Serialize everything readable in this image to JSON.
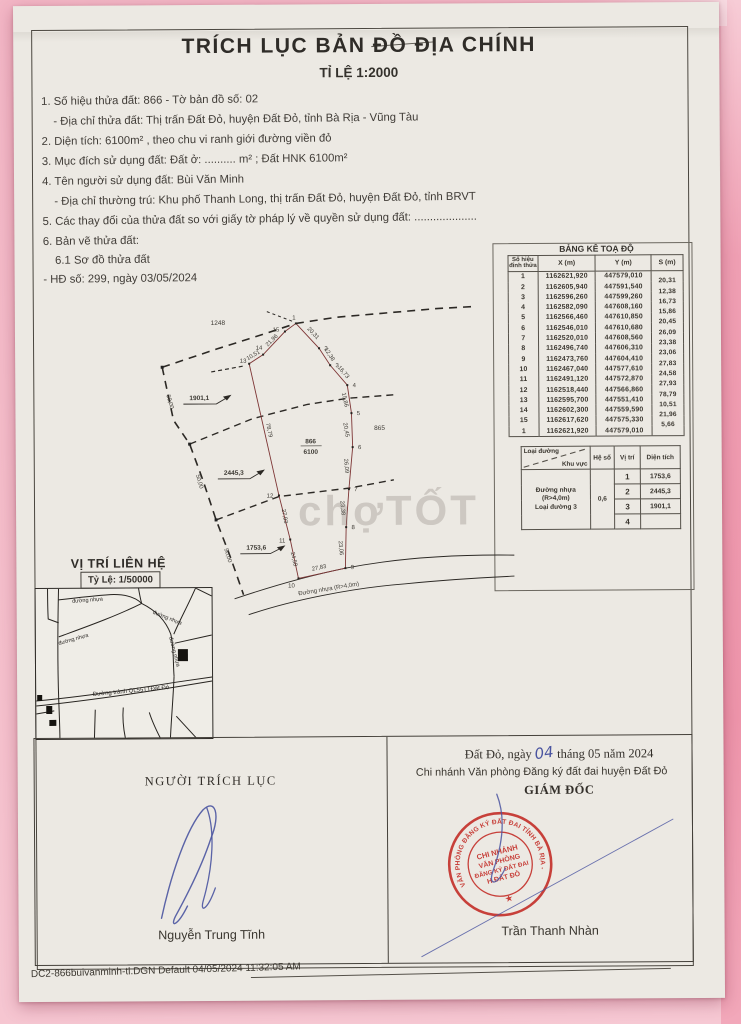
{
  "document": {
    "title": "TRÍCH LỤC BẢN ĐỒ ĐỊA CHÍNH",
    "subtitle": "TỈ LỆ 1:2000",
    "info": {
      "l1": "1. Số hiệu thửa đất:    866      - Tờ bản đồ số:   02",
      "l2": "- Địa chỉ thửa đất: Thị trấn Đất Đỏ, huyện Đất Đỏ, tỉnh Bà Rịa - Vũng Tàu",
      "l3": "2. Diện tích: 6100m² , theo chu vi ranh giới đường viền đỏ",
      "l4": "3. Mục đích sử dụng đất: Đất ở: .......... m² ; Đất HNK  6100m²",
      "l5": "4. Tên người sử dụng đất:  Bùi Văn Minh",
      "l6": "- Địa chỉ thường trú: Khu phố Thanh Long, thị trấn Đất Đỏ, huyện Đất Đỏ, tỉnh BRVT",
      "l7": "5. Các thay đổi của thửa đất so với giấy tờ pháp lý về quyền sử dụng đất: ....................",
      "l8": "6. Bản vẽ thửa đất:",
      "l9": "6.1 Sơ đồ thửa đất",
      "l10": "- HĐ số:  299, ngày 03/05/2024"
    }
  },
  "coord_table": {
    "title": "BẢNG KÊ TOẠ ĐỘ",
    "headers": [
      "Số hiệu đỉnh thửa",
      "X (m)",
      "Y (m)",
      "S (m)"
    ],
    "rows": [
      [
        "1",
        "1162621,920",
        "447579,010",
        "20,31"
      ],
      [
        "2",
        "1162605,940",
        "447591,540",
        "12,38"
      ],
      [
        "3",
        "1162596,260",
        "447599,260",
        "16,73"
      ],
      [
        "4",
        "1162582,090",
        "447608,160",
        "15,86"
      ],
      [
        "5",
        "1162566,460",
        "447610,850",
        "20,45"
      ],
      [
        "6",
        "1162546,010",
        "447610,680",
        "26,09"
      ],
      [
        "7",
        "1162520,010",
        "447608,560",
        "23,38"
      ],
      [
        "8",
        "1162496,740",
        "447606,310",
        "23,06"
      ],
      [
        "9",
        "1162473,760",
        "447604,410",
        "27,83"
      ],
      [
        "10",
        "1162467,040",
        "447577,610",
        "24,58"
      ],
      [
        "11",
        "1162491,120",
        "447572,870",
        "27,93"
      ],
      [
        "12",
        "1162518,440",
        "447566,860",
        "78,79"
      ],
      [
        "13",
        "1162595,700",
        "447551,410",
        "10,51"
      ],
      [
        "14",
        "1162602,300",
        "447559,590",
        "21,96"
      ],
      [
        "15",
        "1162617,620",
        "447575,330",
        "5,66"
      ],
      [
        "1",
        "1162621,920",
        "447579,010",
        ""
      ]
    ]
  },
  "road_table": {
    "corner_top": "Loại đường",
    "corner_bottom": "Khu vực",
    "col_coeff": "Hệ số",
    "col_pos": "Vị trí",
    "col_area": "Diện tích",
    "road_type_lines": [
      "Đường nhựa",
      "(R>4,0m)",
      "Loại đường 3"
    ],
    "coeff": "0,6",
    "rows": [
      [
        "1",
        "1753,6"
      ],
      [
        "2",
        "2445,3"
      ],
      [
        "3",
        "1901,1"
      ],
      [
        "4",
        ""
      ]
    ]
  },
  "drawing": {
    "parcel_no": "866",
    "parcel_area": "6100",
    "neighbor_top": "1248",
    "neighbor_right": "865",
    "subareas": [
      "1901,1",
      "2445,3",
      "1753,6"
    ],
    "side_lengths": [
      "50,00",
      "50,00",
      "50,00"
    ],
    "road_label": "Đường nhựa (R>4,0m)",
    "vertices": [
      "1",
      "2",
      "3",
      "4",
      "5",
      "6",
      "7",
      "8",
      "9",
      "10",
      "11",
      "12",
      "13",
      "14",
      "15"
    ],
    "segments": [
      "20,31",
      "12,38",
      "16,73",
      "15,86",
      "20,45",
      "26,09",
      "23,38",
      "23,06",
      "27,83",
      "24,58",
      "27,93",
      "78,79",
      "10,51",
      "21,96"
    ],
    "watermark": "chợTỐT"
  },
  "location_map": {
    "title": "VỊ TRÍ LIÊN HỆ",
    "scale": "Tỷ Lệ: 1/50000",
    "road_labels": [
      "đường nhựa",
      "đường nhựa",
      "đường nhựa",
      "đường nhựa"
    ],
    "bypass": "Đường tránh QL55TTĐất Đỏ"
  },
  "signing": {
    "left_title": "NGƯỜI TRÍCH LỤC",
    "left_name": "Nguyễn Trung Tĩnh",
    "place_date": {
      "prefix": "Đất Đỏ, ngày",
      "day": "04",
      "thang": "tháng",
      "month": "05",
      "nam": "năm",
      "year": "2024"
    },
    "office": "Chi nhánh Văn phòng Đăng ký đất đai huyện Đất Đỏ",
    "right_title": "GIÁM ĐỐC",
    "right_name": "Trần Thanh Nhàn",
    "stamp": {
      "ring": "VĂN PHÒNG ĐĂNG KÝ ĐẤT ĐAI TỈNH BÀ RỊA - VŨNG TÀU",
      "center": [
        "CHI NHÁNH",
        "VĂN PHÒNG",
        "ĐĂNG KÝ ĐẤT ĐAI",
        "H.ĐẤT ĐỎ"
      ],
      "star": "★"
    }
  },
  "footer": "DC2-866buivanminh-tl.DGN Default 04/05/2024 11:32:05 AM"
}
